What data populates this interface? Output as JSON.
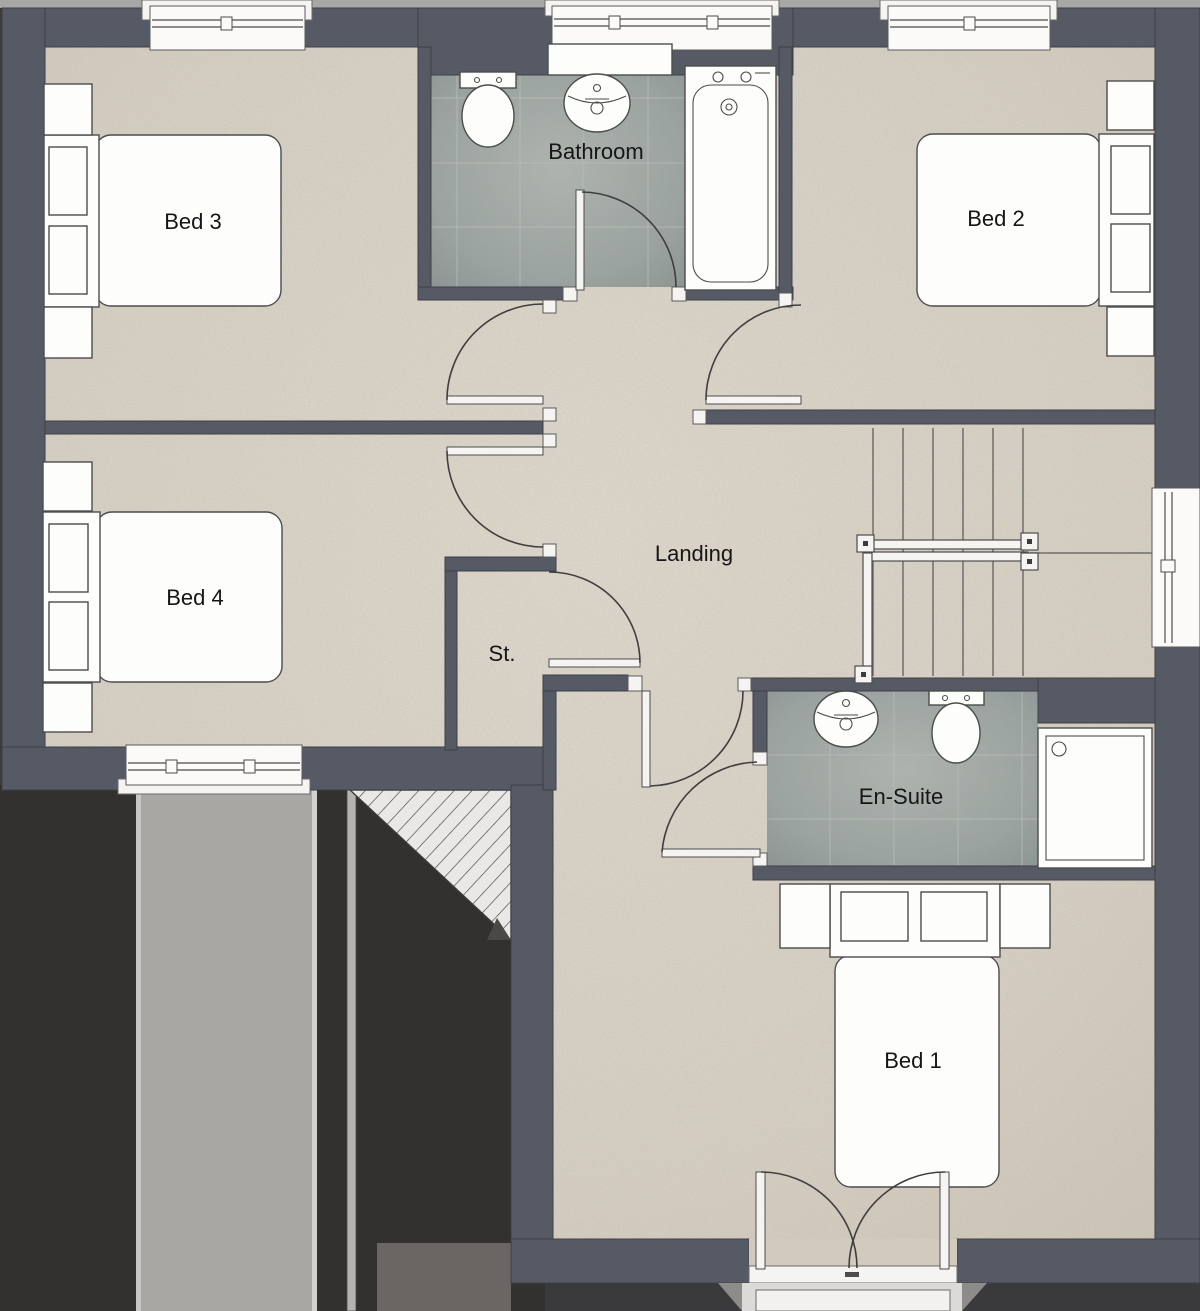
{
  "rooms": [
    {
      "id": "bed3",
      "label": "Bed 3"
    },
    {
      "id": "bathroom",
      "label": "Bathroom"
    },
    {
      "id": "bed2",
      "label": "Bed 2"
    },
    {
      "id": "bed4",
      "label": "Bed 4"
    },
    {
      "id": "landing",
      "label": "Landing"
    },
    {
      "id": "store",
      "label": "St."
    },
    {
      "id": "ensuite",
      "label": "En-Suite"
    },
    {
      "id": "bed1",
      "label": "Bed 1"
    }
  ],
  "fixtures": {
    "bed": "double-bed-icon",
    "pillow": "pillow-icon",
    "bedside_table": "bedside-table-icon",
    "bath": "bathtub-icon",
    "toilet": "toilet-icon",
    "basin": "sink-basin-icon",
    "shower": "shower-tray-icon",
    "stairs": "staircase-icon",
    "handrail": "handrail-icon",
    "window": "window-icon",
    "door": "door-swing-icon",
    "french_doors": "french-doors-icon",
    "balcony": "juliet-balcony-icon",
    "roof": "pitched-roof-icon"
  },
  "colors": {
    "wall": "#565a64",
    "wall_edge": "#3e4049",
    "fixture_fill": "#fdfdfc",
    "white_trim": "#f5f4f2",
    "outline": "#4c4c4c",
    "door_arc": "#3f3f3f",
    "text": "#161616",
    "outside_dark": "#323130",
    "shadow": "#3a393b",
    "roof_band": "#a9a7a4",
    "ridge": "#b5b2af",
    "hatch_bg": "#e9e8e6",
    "balcony": "#dbdad8",
    "top_strip": "#a7a7a5",
    "tile_line": "#b9bfbc",
    "tread": "#6e6e68",
    "floor": "#d6cfc3",
    "tile": "#9aa3a1"
  }
}
